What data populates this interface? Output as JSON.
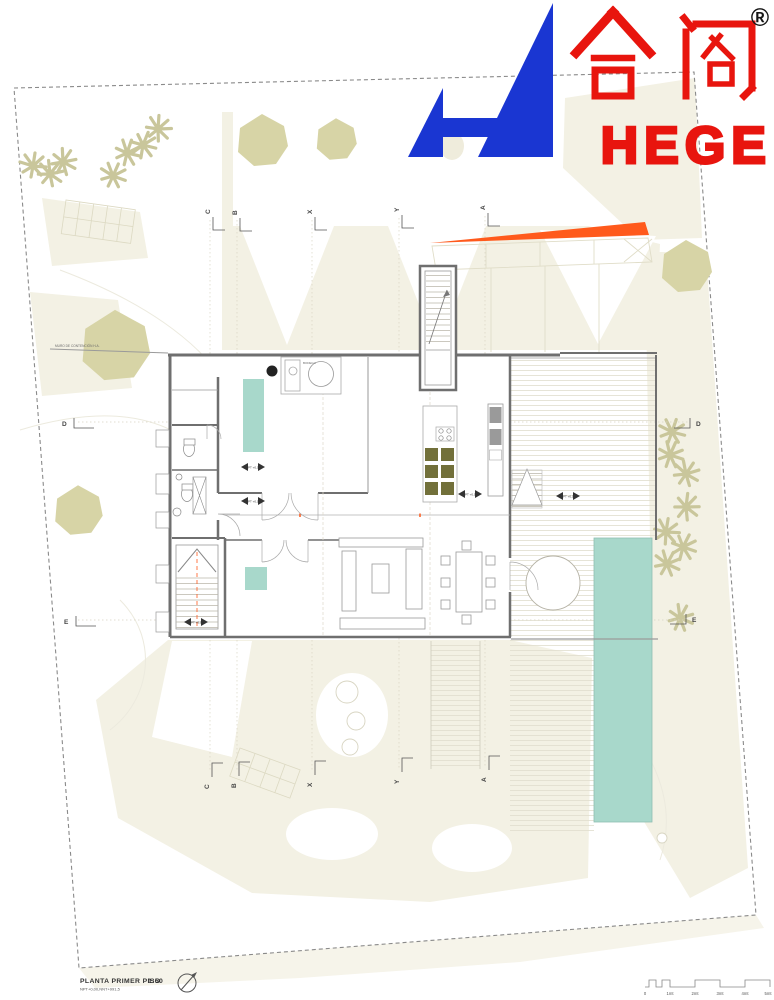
{
  "sheet": {
    "title": "PLANTA PRIMER PISO",
    "scale": "1:50",
    "levels_note": "NPT+0,00,NNT+991,5"
  },
  "logo": {
    "chinese": "合阁",
    "latin": "HEGE",
    "registered": "®"
  },
  "grid": {
    "top": [
      "C",
      "B",
      "X",
      "Y",
      "A"
    ],
    "bottom": [
      "C",
      "B",
      "X",
      "Y",
      "A"
    ],
    "left": [
      "D",
      "E"
    ],
    "right": [
      "D",
      "E"
    ]
  },
  "scale_bar": {
    "labels": [
      "0",
      "1mt",
      "2mt",
      "3mt",
      "4mt",
      "5mt"
    ]
  },
  "plan_labels": {
    "retaining_wall": "MURO DE CONTENCIÓN H.A.",
    "storage": "BODEGA",
    "level_marker": "NPT +0,00"
  },
  "colors": {
    "logo_blue": "#1a36d2",
    "logo_red": "#e8150e",
    "accent_orange": "#ff5a1c",
    "water_teal": "#a8d8cb",
    "kitchen_olive": "#72703a",
    "terrain_beige": "#f3f1e4",
    "canopy_olive": "#d7d4a6"
  }
}
